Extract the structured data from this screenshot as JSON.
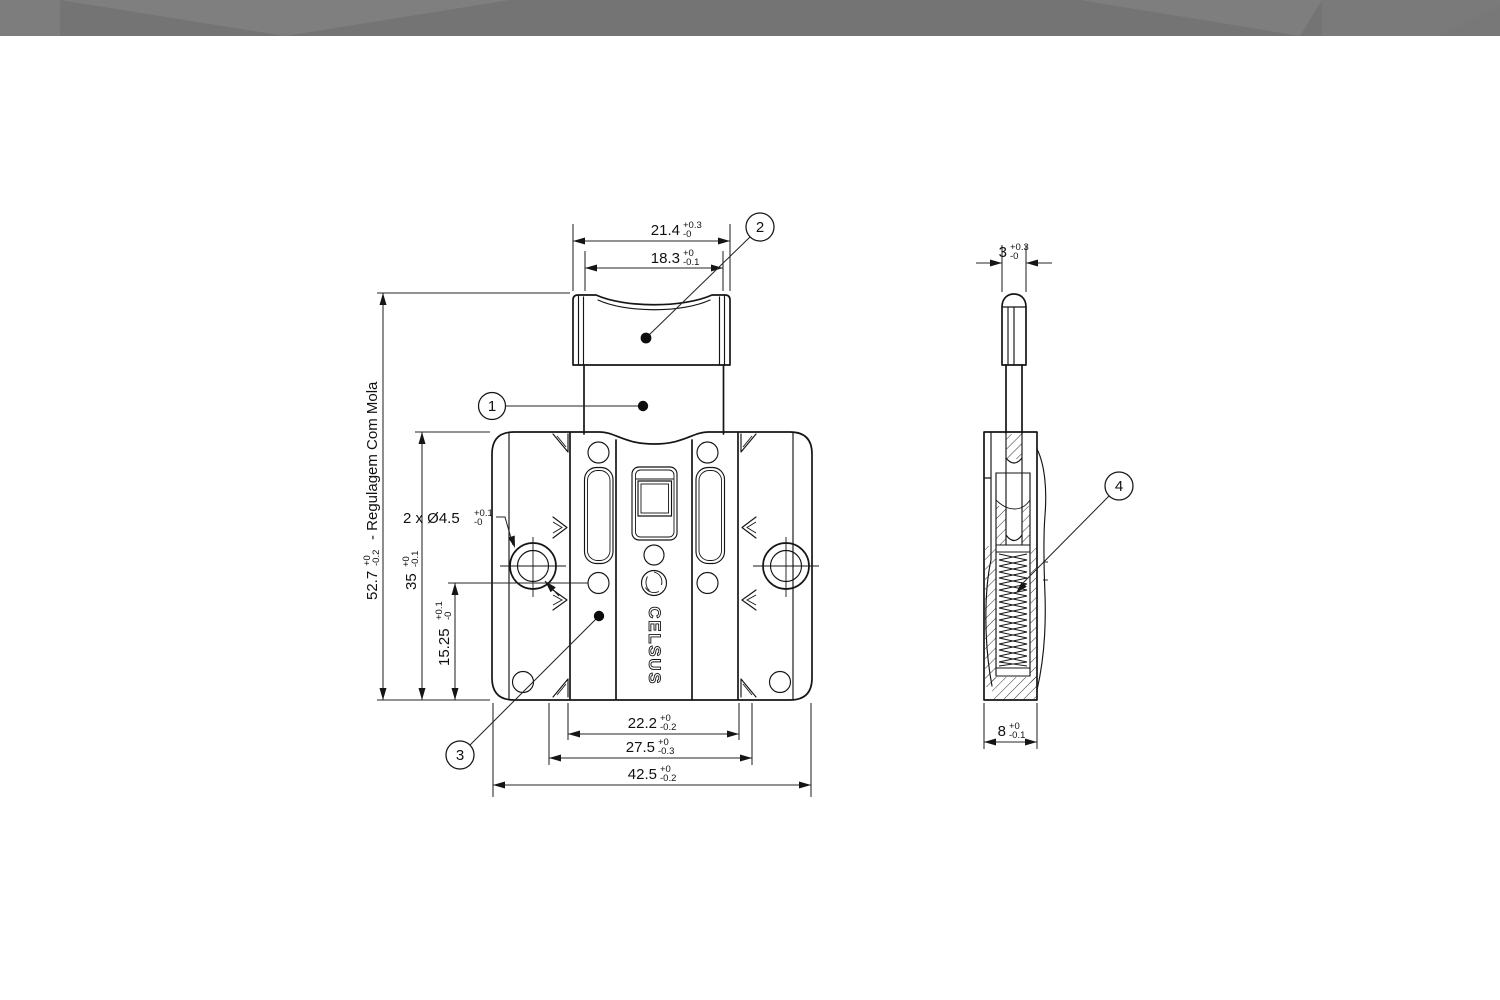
{
  "header": {
    "style": "faceted-gray-banner",
    "colors": {
      "base": "#747474",
      "facet_light": "#7f7f7f",
      "facet_mid": "#7a7a7a",
      "facet_left_block": "#7d7d7d"
    }
  },
  "drawing": {
    "logo_text": "CELSUS",
    "balloons": {
      "b1": "1",
      "b2": "2",
      "b3": "3",
      "b4": "4"
    },
    "dims": {
      "top_outer": {
        "value": "21.4",
        "tol_up": "+0.3",
        "tol_dn": "-0"
      },
      "top_inner": {
        "value": "18.3",
        "tol_up": "+0",
        "tol_dn": "-0.1"
      },
      "overall_height": {
        "value": "52.7",
        "tol_up": "+0",
        "tol_dn": "-0.2",
        "note": "- Regulagem Com Mola"
      },
      "body_height": {
        "value": "35",
        "tol_up": "+0",
        "tol_dn": "-0.1"
      },
      "hole_to_bottom": {
        "value": "15.25",
        "tol_up": "+0.1",
        "tol_dn": "-0"
      },
      "hole_diameter": {
        "value": "2 x Ø4.5",
        "tol_up": "+0.1",
        "tol_dn": "-0"
      },
      "bottom_inner": {
        "value": "22.2",
        "tol_up": "+0",
        "tol_dn": "-0.2"
      },
      "bottom_mid": {
        "value": "27.5",
        "tol_up": "+0",
        "tol_dn": "-0.3"
      },
      "bottom_outer": {
        "value": "42.5",
        "tol_up": "+0",
        "tol_dn": "-0.2"
      },
      "side_width": {
        "value": "3",
        "tol_up": "+0.3",
        "tol_dn": "-0"
      },
      "side_depth": {
        "value": "8",
        "tol_up": "+0",
        "tol_dn": "-0.1"
      }
    },
    "colors": {
      "line": "#151515",
      "paper": "#ffffff"
    }
  }
}
